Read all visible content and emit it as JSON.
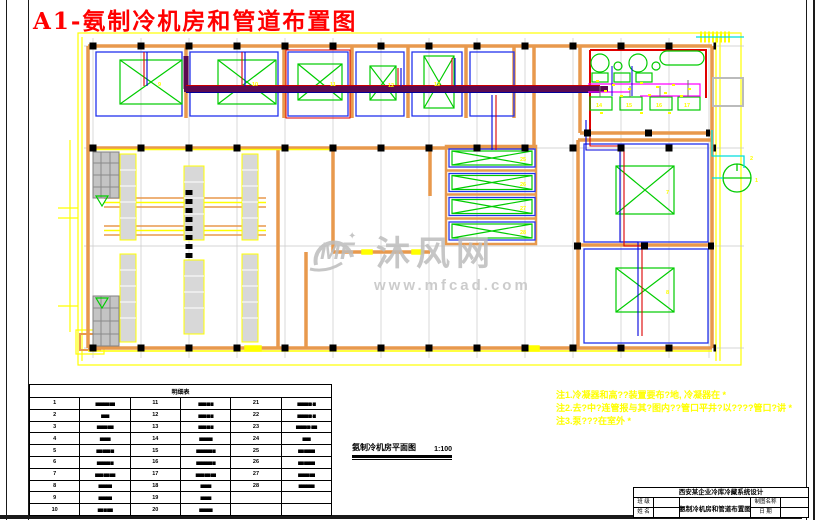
{
  "title": {
    "text": "A1-氨制冷机房和管道布置图",
    "color": "#ff0000"
  },
  "watermark": {
    "logo": "MF",
    "name": "沐风网",
    "url": "www.mfcad.com"
  },
  "notes": {
    "line1": "注1.冷凝器和高??装置要布?地, 冷凝器在 *",
    "line2": "注2.去?中?连管报与其?图内??管口平井?以????管口?讲 *",
    "line3": "注3.泵???在室外 *"
  },
  "caption": {
    "name": "氨制冷机房平面图",
    "scale": "1:100"
  },
  "parts_table": {
    "title": "明细表",
    "rows": [
      [
        "1",
        "▆▆▆▆▆-▆▆",
        "11",
        "▆▆▆-▆-▆",
        "21",
        "▆▆▆▆(▆)-▆"
      ],
      [
        "2",
        "▆▆▆",
        "12",
        "▆▆▆-▆-▆",
        "22",
        "▆▆▆▆(▆)-▆"
      ],
      [
        "3",
        "▆▆▆▆-▆▆",
        "13",
        "▆▆▆-▆-▆",
        "23",
        "▆▆▆▆(▆)-▆▆"
      ],
      [
        "4",
        "▆▆▆▆",
        "14",
        "▆▆▆▆▆",
        "24",
        "▆▆▆"
      ],
      [
        "5",
        "▆▆-▆▆▆-▆",
        "15",
        "▆▆▆▆▆▆-▆",
        "25",
        "▆▆-▆▆▆▆"
      ],
      [
        "6",
        "▆▆▆▆▆-▆",
        "16",
        "▆▆▆▆▆▆-▆",
        "26",
        "▆▆-▆▆▆▆"
      ],
      [
        "7",
        "▆▆▆-▆▆-▆▆",
        "17",
        "▆▆▆-▆▆-▆▆",
        "27",
        "▆▆▆▆-▆▆"
      ],
      [
        "8",
        "▆▆▆▆▆",
        "18",
        "▆▆▆▆",
        "28",
        "▆▆▆▆▆▆"
      ],
      [
        "9",
        "▆▆▆▆▆",
        "19",
        "▆▆▆▆",
        "",
        ""
      ],
      [
        "10",
        "▆▆-▆-▆▆",
        "20",
        "▆▆▆▆▆",
        "",
        ""
      ]
    ]
  },
  "title_block": {
    "project": "西安某企业冷库冷藏系统设计",
    "drawing": "氨制冷机房和管道布置图",
    "field_class": "班 级",
    "field_name": "姓 名",
    "field_chart": "制图名称",
    "field_date": "日 期"
  },
  "plan_labels": {
    "room1": "9",
    "room2": "10",
    "room3": "11",
    "room4": "12",
    "room5": "13",
    "comp1": "14",
    "comp2": "15",
    "comp3": "16",
    "comp4": "17",
    "evap1": "25",
    "evap2": "26",
    "evap3": "27",
    "evap4": "28",
    "cold1": "7",
    "cold2": "8",
    "tower": "1",
    "valve": "2"
  },
  "colors": {
    "wall": "#e8994d",
    "room": "#2233ee",
    "equipment": "#00cc00",
    "pipe_main": "#5c0a50",
    "pipe_red": "#dd0000",
    "pipe_blue": "#0000dd",
    "accent": "#ffff00",
    "magenta": "#ff00ff",
    "cyan": "#00dddd"
  }
}
